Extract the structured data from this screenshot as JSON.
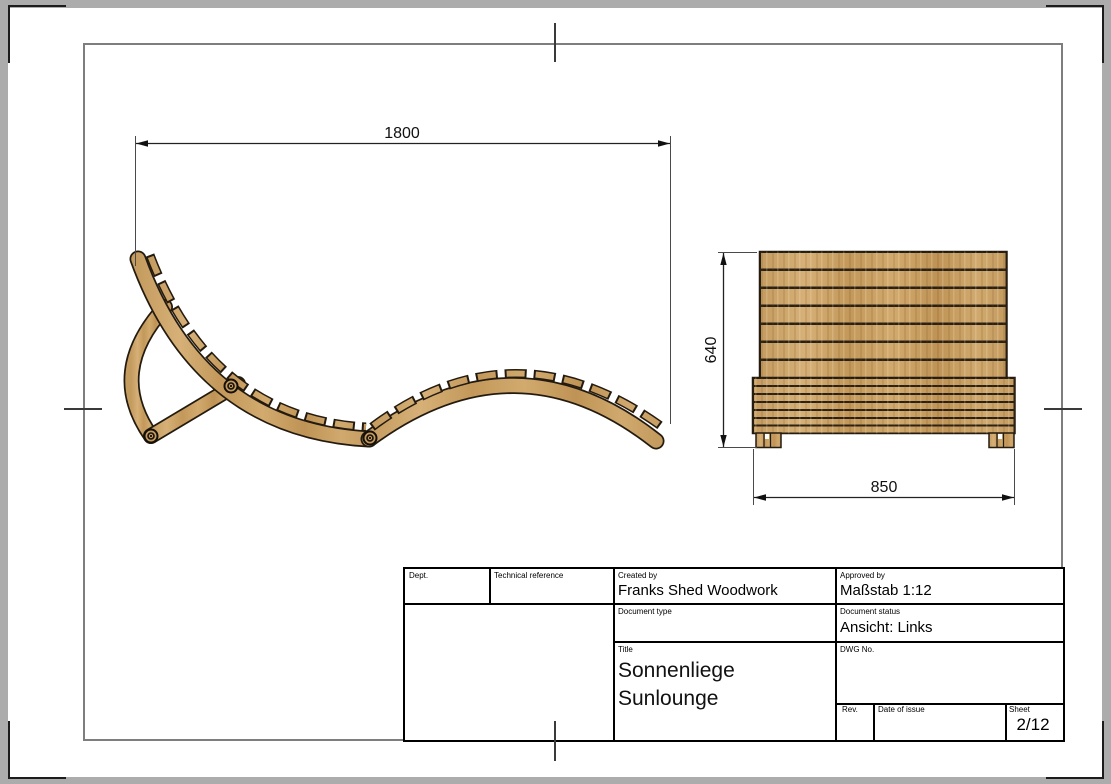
{
  "colors": {
    "background": "#acacac",
    "paper": "#ffffff",
    "frame_line": "#7e7e7e",
    "wood": "#cba46c",
    "wood_dark": "#a57f46",
    "outline": "#241b10"
  },
  "dimensions": {
    "side_length": "1800",
    "front_height": "640",
    "front_width": "850"
  },
  "title_block": {
    "dept_label": "Dept.",
    "technical_reference_label": "Technical reference",
    "created_by_label": "Created by",
    "created_by_value": "Franks Shed Woodwork",
    "approved_by_label": "Approved by",
    "approved_by_value": "Maßstab 1:12",
    "document_type_label": "Document type",
    "document_status_label": "Document status",
    "document_status_value": "Ansicht: Links",
    "title_label": "Title",
    "title_value_line1": "Sonnenliege",
    "title_value_line2": "Sunlounge",
    "dwg_no_label": "DWG No.",
    "rev_label": "Rev.",
    "date_of_issue_label": "Date of issue",
    "sheet_label": "Sheet",
    "sheet_value": "2/12"
  }
}
